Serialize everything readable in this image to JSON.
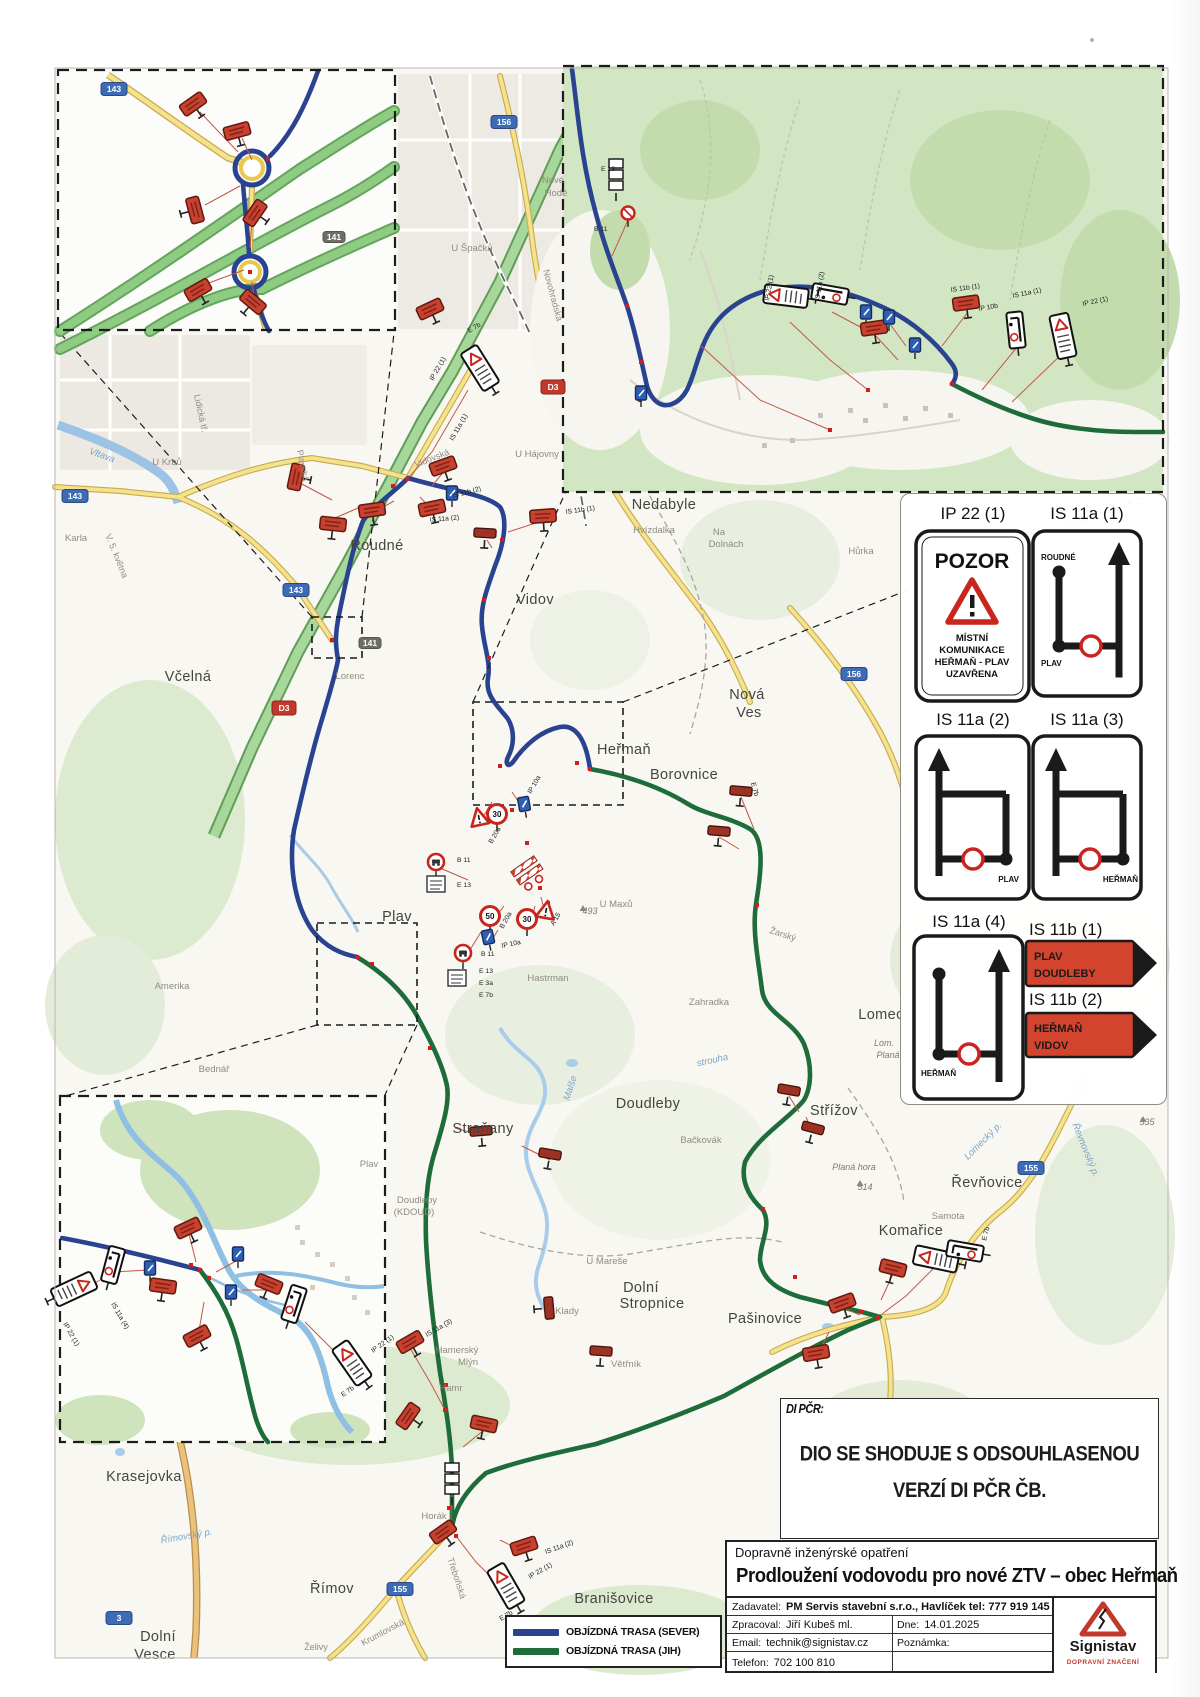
{
  "di_note": {
    "label": "DI PČR:",
    "line1": "DIO SE SHODUJE S ODSOUHLASENOU",
    "line2": "VERZÍ DI PČR ČB."
  },
  "title_block": {
    "category": "Dopravně inženýrské opatření",
    "title": "Prodloužení vodovodu pro nové ZTV – obec Heřmaň",
    "zadavatel_label": "Zadavatel:",
    "zadavatel_value": "PM Servis stavební s.r.o., Havlíček tel: 777 919 145",
    "zpracoval_label": "Zpracoval:",
    "zpracoval_value": "Jiří Kubeš ml.",
    "dne_label": "Dne:",
    "dne_value": "14.01.2025",
    "email_label": "Email:",
    "email_value": "technik@signistav.cz",
    "poznamka_label": "Poznámka:",
    "poznamka_value": "",
    "telefon_label": "Telefon:",
    "telefon_value": "702 100 810"
  },
  "logo": {
    "name": "Signistav",
    "tagline": "DOPRAVNÍ ZNAČENÍ"
  },
  "route_legend": {
    "sever": "OBJÍZDNÁ TRASA (SEVER)",
    "jih": "OBJÍZDNÁ TRASA (JIH)",
    "sever_color": "#2a4390",
    "jih_color": "#1d6c3a"
  },
  "legend_panel": {
    "ip22_code": "IP 22 (1)",
    "ip22_title": "POZOR",
    "ip22_l1": "MÍSTNÍ",
    "ip22_l2": "KOMUNIKACE",
    "ip22_l3": "HEŘMAŇ - PLAV",
    "ip22_l4": "UZAVŘENA",
    "is11a1_code": "IS 11a (1)",
    "is11a1_top": "ROUDNÉ",
    "is11a1_bottom": "PLAV",
    "is11a2_code": "IS 11a (2)",
    "is11a2_label": "PLAV",
    "is11a3_code": "IS 11a (3)",
    "is11a3_label": "HEŘMAŇ",
    "is11a4_code": "IS 11a (4)",
    "is11a4_label": "HEŘMAŇ",
    "is11b1_code": "IS 11b (1)",
    "is11b1_l1": "PLAV",
    "is11b1_l2": "DOUDLEBY",
    "is11b2_code": "IS 11b (2)",
    "is11b2_l1": "HEŘMAŇ",
    "is11b2_l2": "VIDOV"
  },
  "map": {
    "places": [
      {
        "t": "Roudné",
        "x": 377,
        "y": 550,
        "c": "town"
      },
      {
        "t": "Vidov",
        "x": 535,
        "y": 604,
        "c": "town"
      },
      {
        "t": "Nedabyle",
        "x": 664,
        "y": 509,
        "c": "town"
      },
      {
        "t": "Včelná",
        "x": 188,
        "y": 681,
        "c": "town"
      },
      {
        "t": "Heřmaň",
        "x": 624,
        "y": 754,
        "c": "town"
      },
      {
        "t": "Borovnice",
        "x": 684,
        "y": 779,
        "c": "town"
      },
      {
        "t": "Nová",
        "x": 747,
        "y": 699,
        "c": "town"
      },
      {
        "t": "Ves",
        "x": 749,
        "y": 717,
        "c": "town"
      },
      {
        "t": "Plav",
        "x": 397,
        "y": 921,
        "c": "town"
      },
      {
        "t": "Doudleby",
        "x": 648,
        "y": 1108,
        "c": "town"
      },
      {
        "t": "Straňany",
        "x": 483,
        "y": 1133,
        "c": "town"
      },
      {
        "t": "Střížov",
        "x": 834,
        "y": 1115,
        "c": "town"
      },
      {
        "t": "Řevňovice",
        "x": 987,
        "y": 1187,
        "c": "town"
      },
      {
        "t": "Komařice",
        "x": 911,
        "y": 1235,
        "c": "town"
      },
      {
        "t": "Pašinovice",
        "x": 765,
        "y": 1323,
        "c": "town"
      },
      {
        "t": "Dolní",
        "x": 641,
        "y": 1292,
        "c": "town"
      },
      {
        "t": "Stropnice",
        "x": 652,
        "y": 1308,
        "c": "town"
      },
      {
        "t": "Krasejovka",
        "x": 144,
        "y": 1481,
        "c": "town"
      },
      {
        "t": "Římov",
        "x": 332,
        "y": 1593,
        "c": "town"
      },
      {
        "t": "Dolní",
        "x": 158,
        "y": 1641,
        "c": "town"
      },
      {
        "t": "Vesce",
        "x": 155,
        "y": 1659,
        "c": "town"
      },
      {
        "t": "Branišovice",
        "x": 614,
        "y": 1603,
        "c": "town"
      },
      {
        "t": "Lomec",
        "x": 881,
        "y": 1019,
        "c": "town"
      },
      {
        "t": "Hvízdalka",
        "x": 654,
        "y": 533,
        "c": "sm"
      },
      {
        "t": "U Krbů",
        "x": 167,
        "y": 465,
        "c": "sm"
      },
      {
        "t": "Karla",
        "x": 76,
        "y": 541,
        "c": "sm"
      },
      {
        "t": "Lorenc",
        "x": 350,
        "y": 679,
        "c": "sm"
      },
      {
        "t": "Nové",
        "x": 553,
        "y": 183,
        "c": "sm"
      },
      {
        "t": "Hodě",
        "x": 556,
        "y": 196,
        "c": "sm"
      },
      {
        "t": "U Špačků",
        "x": 472,
        "y": 251,
        "c": "sm"
      },
      {
        "t": "U Hájovny",
        "x": 537,
        "y": 457,
        "c": "sm"
      },
      {
        "t": "Na",
        "x": 719,
        "y": 535,
        "c": "sm"
      },
      {
        "t": "Dolnách",
        "x": 726,
        "y": 547,
        "c": "sm"
      },
      {
        "t": "Hůrka",
        "x": 861,
        "y": 554,
        "c": "sm"
      },
      {
        "t": "Hastrman",
        "x": 548,
        "y": 981,
        "c": "sm"
      },
      {
        "t": "U Maxů",
        "x": 616,
        "y": 907,
        "c": "sm"
      },
      {
        "t": "Zahradka",
        "x": 709,
        "y": 1005,
        "c": "sm"
      },
      {
        "t": "Bačkovák",
        "x": 701,
        "y": 1143,
        "c": "sm"
      },
      {
        "t": "U Mareše",
        "x": 607,
        "y": 1264,
        "c": "sm"
      },
      {
        "t": "Amerika",
        "x": 172,
        "y": 989,
        "c": "sm"
      },
      {
        "t": "Bednář",
        "x": 214,
        "y": 1072,
        "c": "sm"
      },
      {
        "t": "Samota",
        "x": 948,
        "y": 1219,
        "c": "sm"
      },
      {
        "t": "Klady",
        "x": 567,
        "y": 1314,
        "c": "sm"
      },
      {
        "t": "Větřník",
        "x": 626,
        "y": 1367,
        "c": "sm"
      },
      {
        "t": "Hamr",
        "x": 451,
        "y": 1391,
        "c": "sm"
      },
      {
        "t": "Hamerský",
        "x": 457,
        "y": 1353,
        "c": "sm"
      },
      {
        "t": "Mlýn",
        "x": 468,
        "y": 1365,
        "c": "sm"
      },
      {
        "t": "Horák",
        "x": 434,
        "y": 1519,
        "c": "sm"
      },
      {
        "t": "Plav",
        "x": 369,
        "y": 1167,
        "c": "sm"
      },
      {
        "t": "Doudleby",
        "x": 417,
        "y": 1203,
        "c": "sm"
      },
      {
        "t": "(KDOUD)",
        "x": 414,
        "y": 1215,
        "c": "sm"
      },
      {
        "t": "Vidovská",
        "x": 433,
        "y": 461,
        "c": "st",
        "r": -22
      },
      {
        "t": "Plavská",
        "x": 300,
        "y": 466,
        "c": "st",
        "r": 78
      },
      {
        "t": "Novohradská",
        "x": 550,
        "y": 296,
        "c": "st",
        "r": 75
      },
      {
        "t": "Lidická tř.",
        "x": 198,
        "y": 414,
        "c": "st",
        "r": 78
      },
      {
        "t": "V. 5. května",
        "x": 114,
        "y": 557,
        "c": "st",
        "r": 68
      },
      {
        "t": "Třeboňská",
        "x": 454,
        "y": 1579,
        "c": "st",
        "r": 72
      },
      {
        "t": "Krumlovská",
        "x": 384,
        "y": 1635,
        "c": "st",
        "r": -28
      },
      {
        "t": "Želivy",
        "x": 316,
        "y": 1650,
        "c": "st"
      },
      {
        "t": "Žarský",
        "x": 782,
        "y": 937,
        "c": "st",
        "r": 18
      },
      {
        "t": "Vltava",
        "x": 101,
        "y": 458,
        "c": "wt",
        "r": 20
      },
      {
        "t": "Malše",
        "x": 573,
        "y": 1089,
        "c": "wt",
        "r": -72
      },
      {
        "t": "Římovský p.",
        "x": 187,
        "y": 1539,
        "c": "wt",
        "r": -10
      },
      {
        "t": "Lomecký p.",
        "x": 985,
        "y": 1143,
        "c": "wt",
        "r": -45
      },
      {
        "t": "Řevnovský p.",
        "x": 1083,
        "y": 1151,
        "c": "wt",
        "r": 68
      },
      {
        "t": "strouha",
        "x": 713,
        "y": 1063,
        "c": "wt",
        "r": -12
      },
      {
        "t": "493",
        "x": 590,
        "y": 914,
        "c": "el"
      },
      {
        "t": "514",
        "x": 865,
        "y": 1190,
        "c": "el"
      },
      {
        "t": "535",
        "x": 1147,
        "y": 1125,
        "c": "el"
      },
      {
        "t": "Planá hora",
        "x": 854,
        "y": 1170,
        "c": "el"
      },
      {
        "t": "Lom.",
        "x": 884,
        "y": 1046,
        "c": "el"
      },
      {
        "t": "Planá",
        "x": 888,
        "y": 1058,
        "c": "el"
      }
    ],
    "shields": [
      {
        "t": "143",
        "x": 75,
        "y": 496,
        "k": "b"
      },
      {
        "t": "143",
        "x": 296,
        "y": 590,
        "k": "b"
      },
      {
        "t": "143",
        "x": 114,
        "y": 89,
        "k": "b"
      },
      {
        "t": "156",
        "x": 504,
        "y": 122,
        "k": "b"
      },
      {
        "t": "156",
        "x": 854,
        "y": 674,
        "k": "b"
      },
      {
        "t": "155",
        "x": 1031,
        "y": 1168,
        "k": "b"
      },
      {
        "t": "155",
        "x": 400,
        "y": 1589,
        "k": "b"
      },
      {
        "t": "3",
        "x": 119,
        "y": 1618,
        "k": "b"
      },
      {
        "t": "D3",
        "x": 284,
        "y": 708,
        "k": "r"
      },
      {
        "t": "D3",
        "x": 553,
        "y": 387,
        "k": "r"
      },
      {
        "t": "141",
        "x": 370,
        "y": 643,
        "k": "g"
      },
      {
        "t": "141",
        "x": 334,
        "y": 237,
        "k": "g"
      }
    ],
    "codes": [
      {
        "t": "IP 22 (1)",
        "x": 433,
        "y": 381,
        "r": -60
      },
      {
        "t": "E 7b",
        "x": 469,
        "y": 333,
        "r": -30
      },
      {
        "t": "IS 11a (1)",
        "x": 453,
        "y": 441,
        "r": -60
      },
      {
        "t": "IS 11b (2)",
        "x": 453,
        "y": 498,
        "r": -15
      },
      {
        "t": "IS 11a (2)",
        "x": 430,
        "y": 522,
        "r": -5
      },
      {
        "t": "IS 11b (1)",
        "x": 566,
        "y": 514,
        "r": -8
      },
      {
        "t": "B 11",
        "x": 457,
        "y": 862,
        "r": 0
      },
      {
        "t": "E 13",
        "x": 457,
        "y": 887,
        "r": 0
      },
      {
        "t": "IP 10a",
        "x": 531,
        "y": 794,
        "r": -60
      },
      {
        "t": "B 20a",
        "x": 492,
        "y": 844,
        "r": -60
      },
      {
        "t": "B 20a",
        "x": 503,
        "y": 929,
        "r": -60
      },
      {
        "t": "A 15",
        "x": 554,
        "y": 926,
        "r": -60
      },
      {
        "t": "B 11",
        "x": 481,
        "y": 956,
        "r": 0
      },
      {
        "t": "E 13",
        "x": 479,
        "y": 973,
        "r": 0
      },
      {
        "t": "E 3a",
        "x": 479,
        "y": 985,
        "r": 0
      },
      {
        "t": "E 7b",
        "x": 479,
        "y": 997,
        "r": 0
      },
      {
        "t": "IP 10a",
        "x": 502,
        "y": 948,
        "r": -12
      },
      {
        "t": "E 7b",
        "x": 751,
        "y": 783,
        "r": 75
      },
      {
        "t": "IS 11a (3)",
        "x": 427,
        "y": 1337,
        "r": -30
      },
      {
        "t": "IP 22 (1)",
        "x": 530,
        "y": 1579,
        "r": -30
      },
      {
        "t": "E 7b",
        "x": 501,
        "y": 1621,
        "r": -30
      },
      {
        "t": "IS 11a (2)",
        "x": 546,
        "y": 1554,
        "r": -20
      },
      {
        "t": "IP 22 (1)",
        "x": 373,
        "y": 1353,
        "r": -35
      },
      {
        "t": "E 7b",
        "x": 343,
        "y": 1397,
        "r": -35
      },
      {
        "t": "IS 11a (4)",
        "x": 111,
        "y": 1304,
        "r": 60
      },
      {
        "t": "IP 22 (1)",
        "x": 63,
        "y": 1324,
        "r": 60
      },
      {
        "t": "E 7b",
        "x": 986,
        "y": 1241,
        "r": -75
      },
      {
        "t": "E 13",
        "x": 601,
        "y": 171,
        "r": 0
      },
      {
        "t": "B 11",
        "x": 594,
        "y": 231,
        "r": 0
      },
      {
        "t": "IS 11b (1)",
        "x": 951,
        "y": 292,
        "r": -8
      },
      {
        "t": "IP 10b",
        "x": 979,
        "y": 311,
        "r": -10
      },
      {
        "t": "IS 11a (1)",
        "x": 1013,
        "y": 298,
        "r": -12
      },
      {
        "t": "IP 22 (1)",
        "x": 1083,
        "y": 306,
        "r": -12
      },
      {
        "t": "IP 22 (1)",
        "x": 769,
        "y": 301,
        "r": -80
      },
      {
        "t": "IS 11a (2)",
        "x": 819,
        "y": 301,
        "r": -80
      }
    ],
    "markers": [
      [
        "red",
        193,
        104,
        -35
      ],
      [
        "red",
        237,
        131,
        -15
      ],
      [
        "red",
        195,
        210,
        75
      ],
      [
        "red",
        255,
        213,
        -55
      ],
      [
        "red",
        198,
        290,
        -30
      ],
      [
        "red",
        253,
        302,
        40
      ],
      [
        "bstack",
        616,
        176,
        0
      ],
      [
        "cred",
        628,
        213,
        0
      ],
      [
        "pozor",
        786,
        296,
        -83
      ],
      [
        "blk",
        830,
        294,
        -80
      ],
      [
        "blue",
        866,
        312,
        0
      ],
      [
        "red",
        874,
        328,
        -8
      ],
      [
        "blue",
        889,
        317,
        0
      ],
      [
        "red",
        966,
        303,
        -8
      ],
      [
        "blk",
        1016,
        330,
        -6
      ],
      [
        "pozor",
        1063,
        336,
        -12
      ],
      [
        "blue",
        915,
        345,
        0
      ],
      [
        "blue",
        641,
        393,
        0
      ],
      [
        "red",
        430,
        309,
        -25
      ],
      [
        "pozor",
        480,
        368,
        -32
      ],
      [
        "red",
        296,
        477,
        -78
      ],
      [
        "red",
        333,
        524,
        6
      ],
      [
        "red",
        372,
        510,
        -8
      ],
      [
        "red",
        432,
        508,
        -12
      ],
      [
        "red",
        443,
        466,
        -20
      ],
      [
        "red",
        543,
        516,
        -4
      ],
      [
        "dred",
        485,
        533,
        3
      ],
      [
        "blue",
        452,
        493,
        0
      ],
      [
        "tri",
        479,
        818,
        -12
      ],
      [
        "circ",
        497,
        814,
        0,
        "30"
      ],
      [
        "blue",
        524,
        804,
        -10
      ],
      [
        "b11",
        436,
        862,
        0
      ],
      [
        "plates",
        436,
        884,
        0
      ],
      [
        "barrier",
        528,
        872,
        -35
      ],
      [
        "circ",
        490,
        916,
        0,
        "50"
      ],
      [
        "circ",
        527,
        919,
        0,
        "30"
      ],
      [
        "tri",
        546,
        911,
        10
      ],
      [
        "blue",
        488,
        937,
        -12
      ],
      [
        "b11",
        463,
        953,
        0
      ],
      [
        "plates",
        457,
        978,
        0
      ],
      [
        "dred",
        741,
        791,
        5
      ],
      [
        "dred",
        719,
        831,
        5
      ],
      [
        "dred",
        789,
        1090,
        10
      ],
      [
        "dred",
        813,
        1128,
        15
      ],
      [
        "dred",
        481,
        1131,
        -5
      ],
      [
        "dred",
        550,
        1154,
        10
      ],
      [
        "pozor",
        936,
        1259,
        -78
      ],
      [
        "blk",
        965,
        1251,
        -80
      ],
      [
        "red",
        893,
        1268,
        14
      ],
      [
        "red",
        842,
        1303,
        -20
      ],
      [
        "red",
        816,
        1353,
        -10
      ],
      [
        "dred",
        601,
        1351,
        4
      ],
      [
        "dred",
        549,
        1308,
        85
      ],
      [
        "red",
        410,
        1342,
        -30
      ],
      [
        "red",
        408,
        1416,
        -55
      ],
      [
        "red",
        484,
        1424,
        12
      ],
      [
        "bstack",
        452,
        1480,
        0
      ],
      [
        "pozor",
        506,
        1586,
        -30
      ],
      [
        "red",
        524,
        1546,
        -18
      ],
      [
        "red",
        443,
        1532,
        -35
      ],
      [
        "pozor",
        74,
        1289,
        65
      ],
      [
        "blk",
        113,
        1265,
        15
      ],
      [
        "red",
        188,
        1228,
        -25
      ],
      [
        "blue",
        150,
        1268,
        0
      ],
      [
        "red",
        163,
        1286,
        8
      ],
      [
        "blue",
        238,
        1254,
        0
      ],
      [
        "red",
        269,
        1284,
        22
      ],
      [
        "blue",
        231,
        1292,
        0
      ],
      [
        "blk",
        294,
        1304,
        18
      ],
      [
        "red",
        197,
        1336,
        -28
      ],
      [
        "pozor",
        352,
        1363,
        -35
      ]
    ],
    "dots": [
      [
        408,
        479
      ],
      [
        393,
        486
      ],
      [
        502,
        540
      ],
      [
        484,
        600
      ],
      [
        489,
        658
      ],
      [
        357,
        957
      ],
      [
        372,
        964
      ],
      [
        590,
        769
      ],
      [
        577,
        763
      ],
      [
        878,
        1317
      ],
      [
        862,
        1312
      ],
      [
        452,
        1528
      ],
      [
        449,
        1508
      ],
      [
        200,
        1270
      ],
      [
        191,
        1265
      ],
      [
        209,
        1278
      ],
      [
        627,
        306
      ],
      [
        641,
        362
      ],
      [
        952,
        384
      ],
      [
        268,
        159
      ],
      [
        250,
        272
      ],
      [
        500,
        766
      ],
      [
        512,
        810
      ],
      [
        527,
        843
      ],
      [
        540,
        888
      ],
      [
        548,
        903
      ],
      [
        430,
        1048
      ],
      [
        446,
        1385
      ],
      [
        763,
        1209
      ],
      [
        795,
        1277
      ],
      [
        757,
        905
      ],
      [
        830,
        430
      ],
      [
        868,
        390
      ],
      [
        640,
        400
      ],
      [
        445,
        1410
      ],
      [
        456,
        1536
      ],
      [
        332,
        640
      ]
    ],
    "peaks": [
      [
        583,
        905
      ],
      [
        860,
        1180
      ],
      [
        1143,
        1116
      ]
    ]
  }
}
